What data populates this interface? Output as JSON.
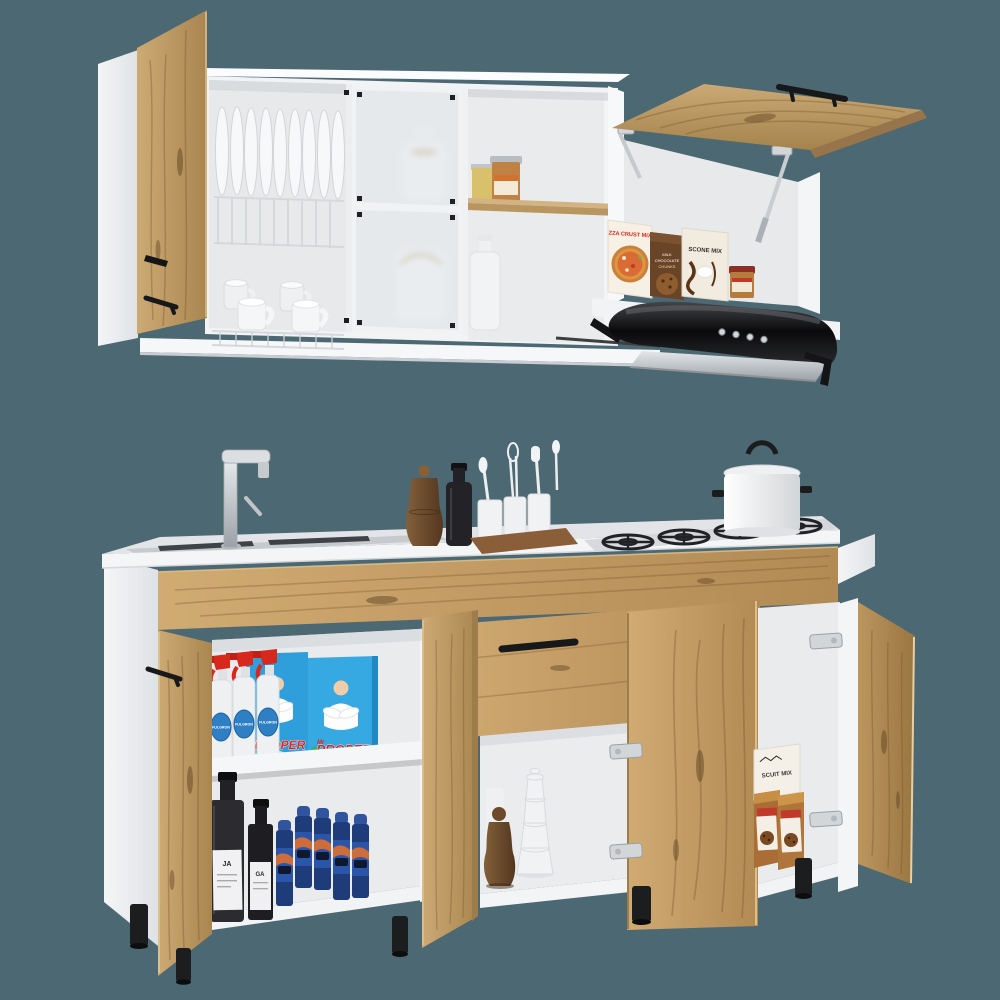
{
  "image": {
    "type": "product-photo",
    "subject": "Two-piece kitchen cabinet set in light oak and white: wall unit with open hinged door, plate rack, frosted-glass doors, lift-up door and black range hood; matching base unit with countertop, sink, faucet, four-burner gas cooktop and open cabinets staged with pantry and cleaning products",
    "background_color": "#4c6872"
  },
  "palette": {
    "background": "#4c6872",
    "wood_light": "#cfab76",
    "wood_mid": "#b99256",
    "wood_dark": "#7f5d33",
    "cabinet_white": "#f4f5f6",
    "interior_gray": "#e9ebed",
    "countertop": "#e2e4e7",
    "steel": "#c6cacd",
    "hood_black": "#121214",
    "detergent_blue": "#2f9fdb",
    "label_red": "#d8281e",
    "aerosol_navy": "#203e80"
  },
  "wall_unit": {
    "labels": {
      "pizza_box": "ZZA CRUST MIX",
      "scone_box": "SCONE MIX",
      "choc_line1": "MILK",
      "choc_line2": "CHOCOLATE",
      "choc_line3": "CHUNKS"
    }
  },
  "base_unit": {
    "labels": {
      "detergent_prefix": "Mr",
      "detergent_box": "PROPER",
      "spray_bottle": "FULGRON",
      "dark_bottle_left": "JA",
      "dark_bottle_right": "GA",
      "biscuit_box": "SCUIT MIX"
    }
  },
  "objects": [
    "wall cabinet with white carcass and light-oak doors",
    "open hinged left door with black handle",
    "wire dish rack with nine upright plates",
    "four white mugs on lower rack",
    "two frosted-glass doors hiding white jug and milk can",
    "open shelf with two preserve jars and a white bottle",
    "lift-up oak door on gas struts with black handle",
    "pantry boxes: pizza crust mix, chocolate chunks, scone mix, small jar",
    "black curved range hood with chrome visor and four buttons",
    "base cabinet with light-oak fronts and white carcass",
    "countertop with inset stainless sink",
    "chrome single-lever faucet",
    "wooden pepper mill and dark oil bottle on counter",
    "wooden caddy with three utensil crocks",
    "four-burner gas cooktop with black grates",
    "white pot with lid on cooktop",
    "left cabinet shelves with spray cleaners, detergent boxes, dark bottles and aerosol cans",
    "middle cabinet with pepper mill and stacked white cups",
    "right cabinet with biscuit mix box and chocolate-chunk bags",
    "black cylindrical feet"
  ]
}
